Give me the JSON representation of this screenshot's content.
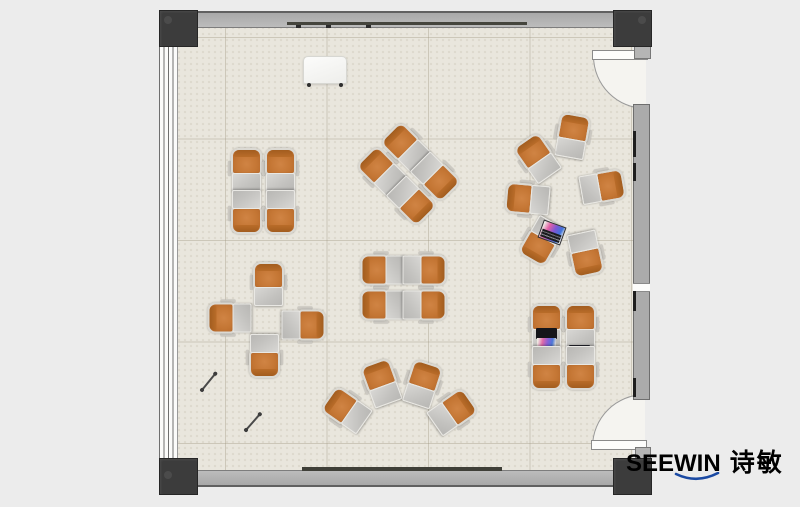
{
  "logo": {
    "brand": "SEEWIN",
    "cjk": "诗敏",
    "color": "#1b4aa3"
  },
  "palette": {
    "page_bg": "#ececec",
    "floor": "#e9e6dd",
    "wall": "#ababab",
    "post": "#3c3c3c",
    "chair_orange": "#c47634",
    "chair_back": "#a25d1f",
    "desk_gray": "#c3c2bf",
    "rail_dark": "#45453d",
    "logo_blue": "#1b4aa3"
  },
  "floorplan": {
    "clusters": [
      {
        "name": "cluster-top-left-quad",
        "units": [
          {
            "x": 246,
            "y": 170,
            "r": 0
          },
          {
            "x": 280,
            "y": 170,
            "r": 0
          },
          {
            "x": 246,
            "y": 212,
            "r": 180
          },
          {
            "x": 280,
            "y": 212,
            "r": 180
          }
        ]
      },
      {
        "name": "cluster-top-center-diamond",
        "units": [
          {
            "x": 381,
            "y": 171,
            "r": -45
          },
          {
            "x": 405,
            "y": 147,
            "r": -45
          },
          {
            "x": 411,
            "y": 201,
            "r": 135
          },
          {
            "x": 435,
            "y": 177,
            "r": 135
          }
        ]
      },
      {
        "name": "cluster-right-circle",
        "units": [
          {
            "x": 572,
            "y": 136,
            "r": 10
          },
          {
            "x": 537,
            "y": 158,
            "r": -35
          },
          {
            "x": 602,
            "y": 187,
            "r": 80
          },
          {
            "x": 527,
            "y": 199,
            "r": -85
          },
          {
            "x": 541,
            "y": 241,
            "r": -150
          },
          {
            "x": 585,
            "y": 254,
            "r": 168
          }
        ]
      },
      {
        "name": "cluster-center-quad",
        "units": [
          {
            "x": 382,
            "y": 270,
            "r": -90
          },
          {
            "x": 424,
            "y": 270,
            "r": 90
          },
          {
            "x": 382,
            "y": 305,
            "r": -90
          },
          {
            "x": 424,
            "y": 305,
            "r": 90
          }
        ]
      },
      {
        "name": "cluster-left-cross",
        "units": [
          {
            "x": 268,
            "y": 284,
            "r": 0
          },
          {
            "x": 229,
            "y": 318,
            "r": -90
          },
          {
            "x": 303,
            "y": 325,
            "r": 90
          },
          {
            "x": 264,
            "y": 356,
            "r": 180
          }
        ]
      },
      {
        "name": "cluster-bottom-fan",
        "units": [
          {
            "x": 346,
            "y": 410,
            "r": -55
          },
          {
            "x": 381,
            "y": 383,
            "r": -20
          },
          {
            "x": 422,
            "y": 384,
            "r": 18
          },
          {
            "x": 452,
            "y": 412,
            "r": 55
          }
        ]
      },
      {
        "name": "cluster-bottom-right-quad",
        "units": [
          {
            "x": 546,
            "y": 326,
            "r": 0,
            "acc": "laptop-open"
          },
          {
            "x": 580,
            "y": 326,
            "r": 0,
            "acc": "tablet"
          },
          {
            "x": 546,
            "y": 368,
            "r": 180
          },
          {
            "x": 580,
            "y": 368,
            "r": 180
          }
        ]
      }
    ],
    "objects": {
      "whiteboard": {
        "x": 303,
        "y": 56,
        "w": 42,
        "h": 26
      },
      "laptop": {
        "x": 540,
        "y": 223,
        "w": 22,
        "h": 17,
        "r": 20
      },
      "sticks": [
        {
          "x1": 202,
          "y1": 389,
          "x2": 215,
          "y2": 373
        },
        {
          "x1": 246,
          "y1": 429,
          "x2": 260,
          "y2": 413
        }
      ]
    }
  }
}
